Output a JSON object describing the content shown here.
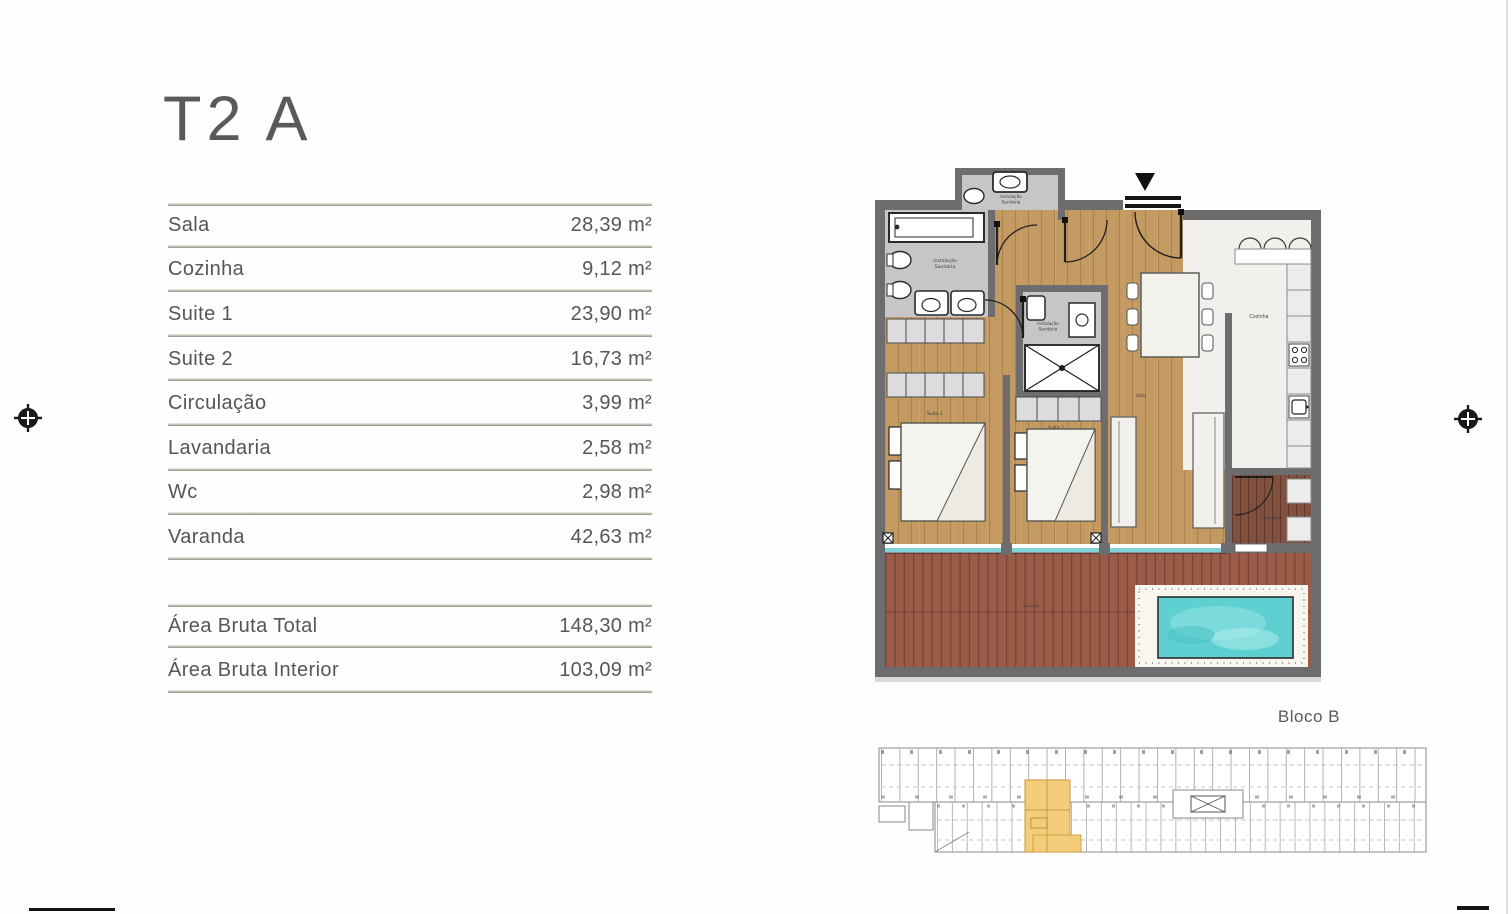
{
  "page": {
    "title": "T2 A"
  },
  "area_table": {
    "rows": [
      {
        "label": "Sala",
        "value": "28,39 m²"
      },
      {
        "label": "Cozinha",
        "value": "9,12 m²"
      },
      {
        "label": "Suite 1",
        "value": "23,90 m²"
      },
      {
        "label": "Suite 2",
        "value": "16,73 m²"
      },
      {
        "label": "Circulação",
        "value": "3,99 m²"
      },
      {
        "label": "Lavandaria",
        "value": "2,58 m²"
      },
      {
        "label": "Wc",
        "value": "2,98 m²"
      },
      {
        "label": "Varanda",
        "value": "42,63 m²"
      }
    ],
    "totals": [
      {
        "label": "Área Bruta Total",
        "value": "148,30 m²"
      },
      {
        "label": "Área Bruta Interior",
        "value": "103,09 m²"
      }
    ]
  },
  "floor_plan": {
    "block_label": "Bloco B",
    "labels": {
      "sanitary_line1": "Instalação",
      "sanitary_line2": "Sanitária",
      "kitchen": "Cozinha",
      "suite1": "Suite 1",
      "suite2": "Suite 2",
      "sala": "Sala",
      "varanda": "Varanda",
      "laundry": "Lavandaria"
    },
    "colors": {
      "wall": "#6d6d6f",
      "wood_floor": "#c39a62",
      "deck": "#9a5c49",
      "tile": "#c6c6c8",
      "marble": "#f2f0ec",
      "pool_water": "#5ed0d2",
      "window_glass": "#7fd2d6",
      "unit_highlight": "#f4cd7b"
    }
  }
}
